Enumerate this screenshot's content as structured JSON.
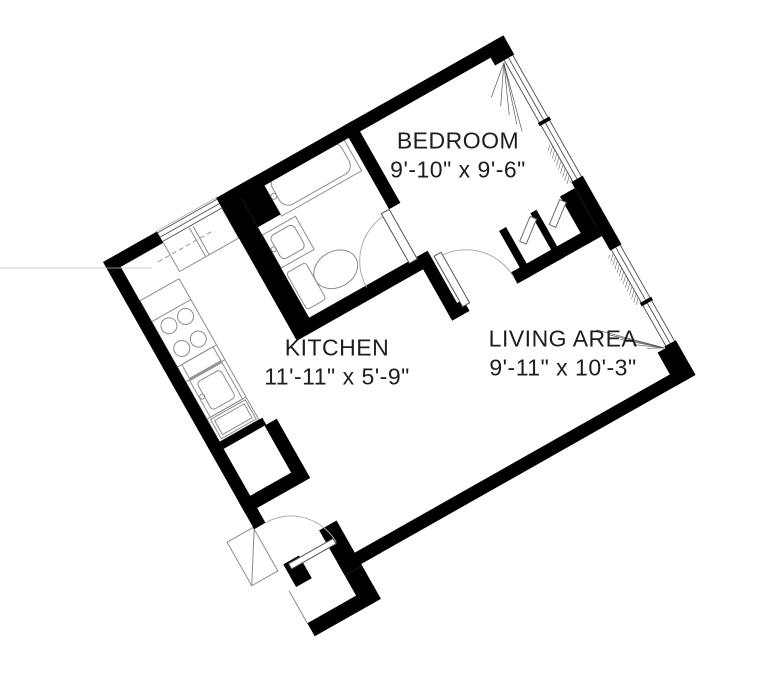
{
  "title": "One-bedroom apartment floor plan",
  "colors": {
    "wall": "#000000",
    "fixture_line": "#8c8c8c",
    "window_line": "#4d4d4d",
    "arc_line": "#aeaeae",
    "fan_line": "#5a5a5a",
    "dashed_line": "#999999",
    "panel_line": "#6f6f6f",
    "leaf_line": "#555555",
    "stray_line": "#bbbbbb",
    "background": "#ffffff",
    "text": "#1d1d1d"
  },
  "rooms": [
    {
      "id": "bedroom",
      "name": "BEDROOM",
      "dims": "9'-10\" x 9'-6\"",
      "x": 458,
      "y": 155
    },
    {
      "id": "kitchen",
      "name": "KITCHEN",
      "dims": "11'-11\" x 5'-9\"",
      "x": 337,
      "y": 362
    },
    {
      "id": "living",
      "name": "LIVING AREA",
      "dims": "9'-11\" x 10'-3\"",
      "x": 563,
      "y": 353
    }
  ],
  "plan": {
    "transform": {
      "x": 103,
      "y": 262,
      "angle": -29.5
    },
    "walls": [
      [
        0,
        0,
        62,
        13
      ],
      [
        130,
        0,
        330,
        13
      ],
      [
        438,
        0,
        22,
        22
      ],
      [
        0,
        13,
        13,
        277
      ],
      [
        13,
        214,
        49,
        8
      ],
      [
        60,
        222,
        14,
        56
      ],
      [
        0,
        276,
        74,
        14
      ],
      [
        0,
        290,
        13,
        17
      ],
      [
        8,
        352,
        18,
        26
      ],
      [
        56,
        340,
        20,
        52
      ],
      [
        56,
        392,
        20,
        25
      ],
      [
        0,
        415,
        76,
        15
      ],
      [
        56,
        377,
        404,
        13
      ],
      [
        438,
        352,
        22,
        38
      ],
      [
        447,
        0,
        13,
        22
      ],
      [
        447,
        93,
        13,
        4
      ],
      [
        447,
        161,
        13,
        79
      ],
      [
        447,
        300,
        13,
        4
      ],
      [
        447,
        350,
        13,
        40
      ],
      [
        130,
        0,
        22,
        163
      ],
      [
        152,
        0,
        26,
        46
      ],
      [
        130,
        150,
        158,
        14
      ],
      [
        275,
        0,
        13,
        95
      ],
      [
        275,
        152,
        13,
        71
      ],
      [
        275,
        210,
        20,
        13
      ],
      [
        350,
        210,
        97,
        13
      ],
      [
        360,
        168,
        8,
        55
      ],
      [
        396,
        168,
        7,
        55
      ],
      [
        430,
        168,
        17,
        55
      ]
    ],
    "windows": [
      {
        "x": 62,
        "y": 0,
        "w": 68,
        "h": 13,
        "o": "h"
      },
      {
        "x": 447,
        "y": 22,
        "w": 13,
        "h": 71,
        "o": "v"
      },
      {
        "x": 447,
        "y": 97,
        "w": 13,
        "h": 64,
        "o": "v"
      },
      {
        "x": 447,
        "y": 240,
        "w": 13,
        "h": 60,
        "o": "v"
      },
      {
        "x": 447,
        "y": 304,
        "w": 13,
        "h": 46,
        "o": "v"
      }
    ],
    "hatches": [
      [
        442,
        118,
        6,
        43
      ],
      [
        442,
        243,
        6,
        57
      ]
    ],
    "outline_rects": [
      {
        "r": [
          13,
          52,
          45,
          162
        ]
      },
      {
        "r": [
          62,
          0,
          68,
          46
        ]
      },
      {
        "r": [
          178,
          4,
          92,
          44
        ]
      },
      {
        "r": [
          184,
          9,
          80,
          34
        ],
        "rx": 10
      },
      {
        "r": [
          152,
          55,
          38,
          38
        ]
      },
      {
        "r": [
          157,
          60,
          27,
          27
        ],
        "rx": 5
      },
      {
        "r": [
          154,
          100,
          22,
          42
        ],
        "rx": 3
      },
      {
        "r": [
          17,
          146,
          37,
          42
        ]
      },
      {
        "r": [
          22,
          151,
          27,
          32
        ],
        "rx": 4
      },
      {
        "r": [
          18,
          128,
          36,
          16
        ]
      },
      {
        "r": [
          16,
          190,
          40,
          22
        ]
      },
      {
        "r": [
          19,
          193,
          34,
          16
        ]
      },
      {
        "r": [
          -30,
          305,
          30,
          50
        ]
      }
    ],
    "ellipses": [
      {
        "cx": 199,
        "cy": 121,
        "rx": 23,
        "ry": 18
      }
    ],
    "circles": [
      [
        26,
        88,
        8
      ],
      [
        45,
        88,
        8
      ],
      [
        26,
        114,
        8
      ],
      [
        45,
        114,
        8
      ],
      [
        155,
        73,
        2.5
      ],
      [
        181,
        27,
        3
      ],
      [
        20,
        166,
        2.5
      ]
    ],
    "lines": [
      [
        13,
        76,
        58,
        76
      ],
      [
        13,
        128,
        58,
        128
      ],
      [
        13,
        145,
        58,
        145
      ],
      [
        13,
        188,
        58,
        188
      ],
      [
        92,
        0,
        92,
        46
      ],
      [
        96,
        0,
        96,
        46
      ],
      [
        0,
        378,
        0,
        415
      ],
      [
        -30,
        355,
        0,
        307
      ]
    ],
    "dashed_lines": [
      [
        48,
        27,
        110,
        27
      ]
    ],
    "door_leaves": [
      [
        13,
        354,
        51,
        6
      ],
      [
        266,
        95,
        9,
        57
      ],
      [
        291,
        158,
        8,
        58
      ]
    ],
    "door_arcs": [
      {
        "r": 52,
        "from": [
          13,
          307
        ],
        "to": [
          65,
          359
        ],
        "sweep": 1
      },
      {
        "r": 54,
        "from": [
          271,
          98
        ],
        "to": [
          217,
          152
        ],
        "sweep": 0
      },
      {
        "r": 55,
        "from": [
          295,
          161
        ],
        "to": [
          350,
          216
        ],
        "sweep": 1
      }
    ],
    "fans": [
      {
        "apex": [
          447,
          24
        ],
        "tips": [
          [
            419,
            48
          ],
          [
            423,
            60
          ],
          [
            426,
            72
          ],
          [
            428,
            84
          ],
          [
            429,
            93
          ]
        ]
      },
      {
        "apex": [
          446,
          351
        ],
        "tips": [
          [
            396,
            302
          ],
          [
            404,
            312
          ],
          [
            412,
            322
          ],
          [
            421,
            333
          ],
          [
            431,
            343
          ]
        ]
      }
    ],
    "panels": [
      {
        "x": 369,
        "y": 170,
        "w": 27,
        "h": 7,
        "a": -38,
        "cx": 396,
        "cy": 173
      },
      {
        "x": 403,
        "y": 170,
        "w": 27,
        "h": 7,
        "a": -38,
        "cx": 430,
        "cy": 173
      }
    ],
    "stray_lines": [
      [
        0,
        268,
        152,
        268
      ]
    ]
  }
}
